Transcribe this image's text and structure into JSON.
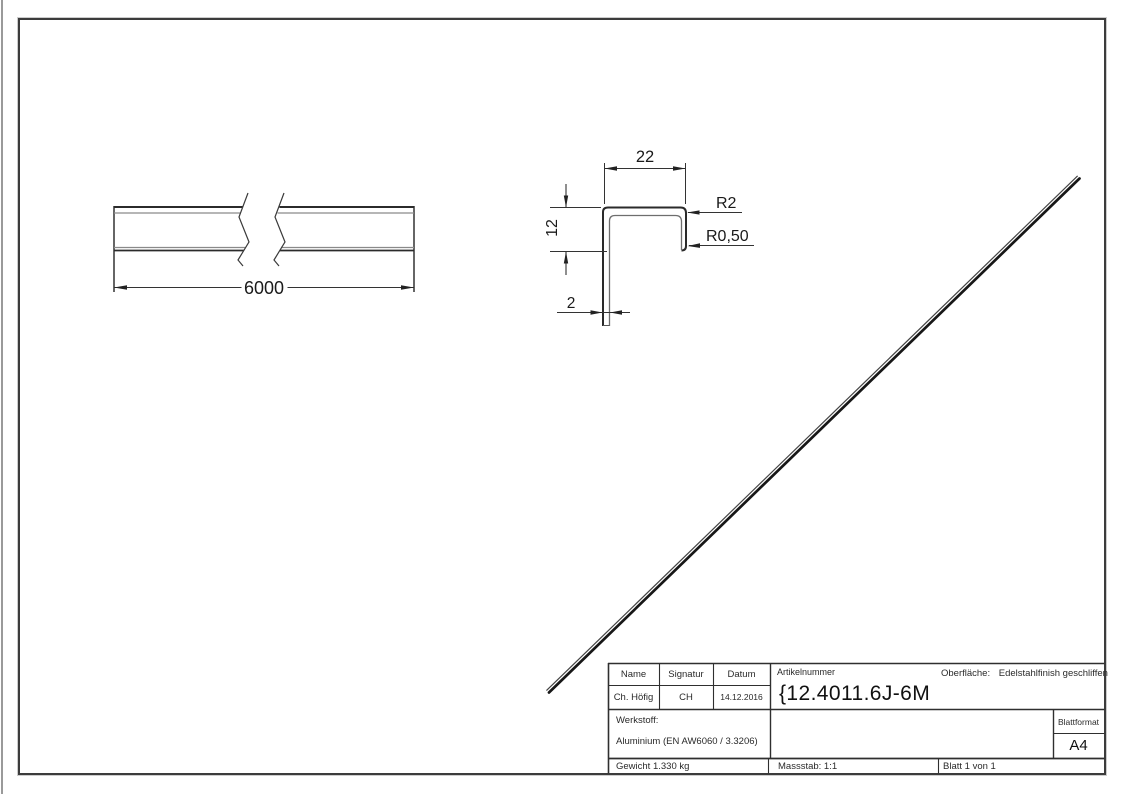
{
  "front_view": {
    "length_dim": "6000"
  },
  "section_view": {
    "width_dim": "22",
    "height_dim": "12",
    "thickness_dim": "2",
    "radius_outer": "R2",
    "radius_inner": "R0,50"
  },
  "title_block": {
    "name_header": "Name",
    "signatur_header": "Signatur",
    "datum_header": "Datum",
    "name": "Ch. Höfig",
    "signatur": "CH",
    "datum": "14.12.2016",
    "artikelnummer_label": "Artikelnummer",
    "artikelnummer": "{12.4011.6J-6M",
    "oberflaeche_label": "Oberfläche:",
    "oberflaeche_value": "Edelstahlfinish geschliffen",
    "werkstoff_label": "Werkstoff:",
    "werkstoff_value": "Aluminium (EN AW6060 / 3.3206)",
    "blattformat_label": "Blattformat",
    "blattformat_value": "A4",
    "gewicht": "Gewicht 1.330 kg",
    "massstab": "Massstab: 1:1",
    "blatt": "Blatt 1 von 1"
  }
}
